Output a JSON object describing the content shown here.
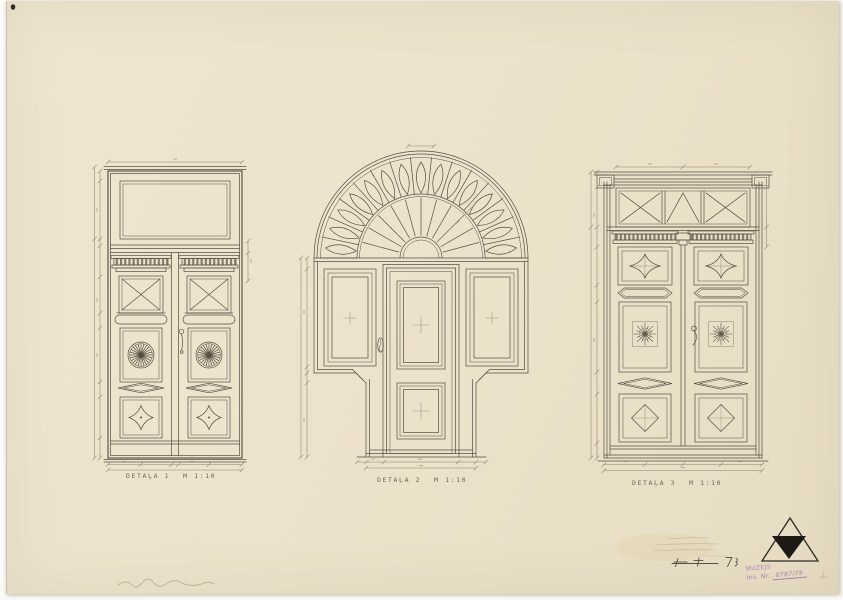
{
  "sheet": {
    "type": "scanned architectural drawing sheet",
    "paper_color": "#ece3cc",
    "ink_color": "#564e44",
    "background_color": "#fbfaf6"
  },
  "drawings": [
    {
      "label": "DETAĻA 1",
      "scale": "M 1:10",
      "subject": "double door with glazed transom, X-panels, fan rosettes and diamond panels"
    },
    {
      "label": "DETAĻA 2",
      "scale": "M 1:10",
      "subject": "doorway with radiating fanlight arch, door leaf and flanking wall panels"
    },
    {
      "label": "DETAĻA 3",
      "scale": "M 1:10",
      "subject": "double door with lattice transom, dentil cornices, star and rosette panels"
    }
  ],
  "stamp": {
    "line1": "MUZEJS",
    "inv_label": "Inv. Nr.",
    "inv_value": "0787/76",
    "color": "#9a6bb0"
  },
  "emblem": "black triangle emblem",
  "notes": {
    "pencil": "faint illegible pencil notes",
    "signature": "faint pencil inscription"
  }
}
